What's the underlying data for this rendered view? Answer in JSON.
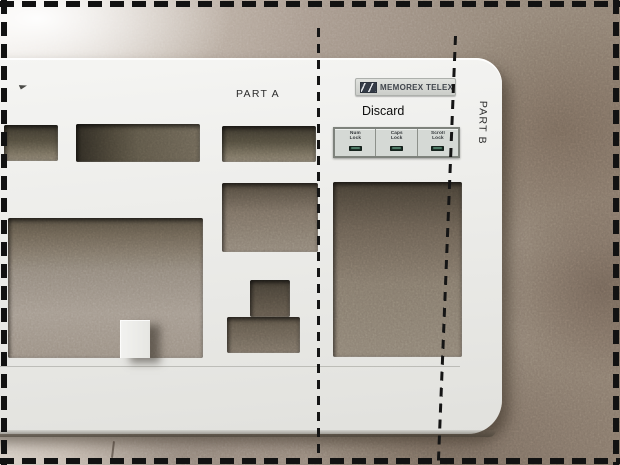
{
  "annotations": {
    "part_a_label": "PART A",
    "discard_label": "Discard",
    "part_b_label": "PART B"
  },
  "keyboard": {
    "badge": {
      "brand_text": "MEMOREX TELEX",
      "logo_icon": "memorex-telex-logo-icon"
    },
    "indicator_panel": {
      "cells": [
        {
          "line1": "Num",
          "line2": "Lock",
          "led_icon": "num-lock-led"
        },
        {
          "line1": "Caps",
          "line2": "Lock",
          "led_icon": "caps-lock-led"
        },
        {
          "line1": "Scroll",
          "line2": "Lock",
          "led_icon": "scroll-lock-led"
        }
      ]
    }
  },
  "colors": {
    "cut_line_dash": "#151515",
    "keyboard_plastic": "#ebebe8",
    "countertop": "#97897b",
    "panel_background": "#d5d9d5",
    "led_green": "#4e7a66"
  }
}
